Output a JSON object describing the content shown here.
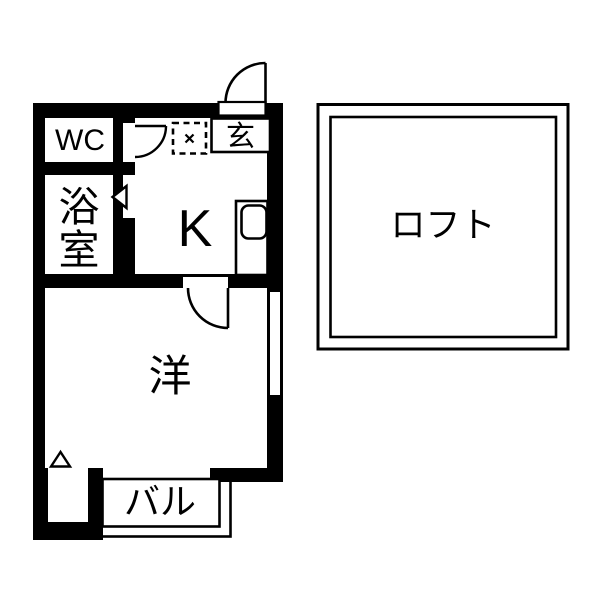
{
  "floor_plan": {
    "type": "japanese-apartment-floorplan",
    "colors": {
      "background": "#ffffff",
      "walls": "#000000",
      "text": "#000000"
    },
    "rooms": {
      "wc": {
        "label": "WC"
      },
      "bath": {
        "label": "浴室",
        "chars": [
          "浴",
          "室"
        ]
      },
      "kitchen": {
        "label": "K"
      },
      "entrance": {
        "label": "玄"
      },
      "western_room": {
        "label": "洋"
      },
      "balcony": {
        "label": "バル"
      },
      "loft": {
        "label": "ロフト"
      }
    },
    "symbols": {
      "entrance_door": "quarter-circle-swing-door",
      "kitchen_to_room_door": "quarter-circle-swing-door",
      "wc_door": "quarter-circle-swing-door",
      "bath_door": "folding-door-triangle",
      "washing_machine_space": "dashed-square-with-cross",
      "kitchen_sink": "counter-with-rounded-sink",
      "window_right_wall": "double-line-window",
      "step_marker": "small-triangle"
    }
  }
}
